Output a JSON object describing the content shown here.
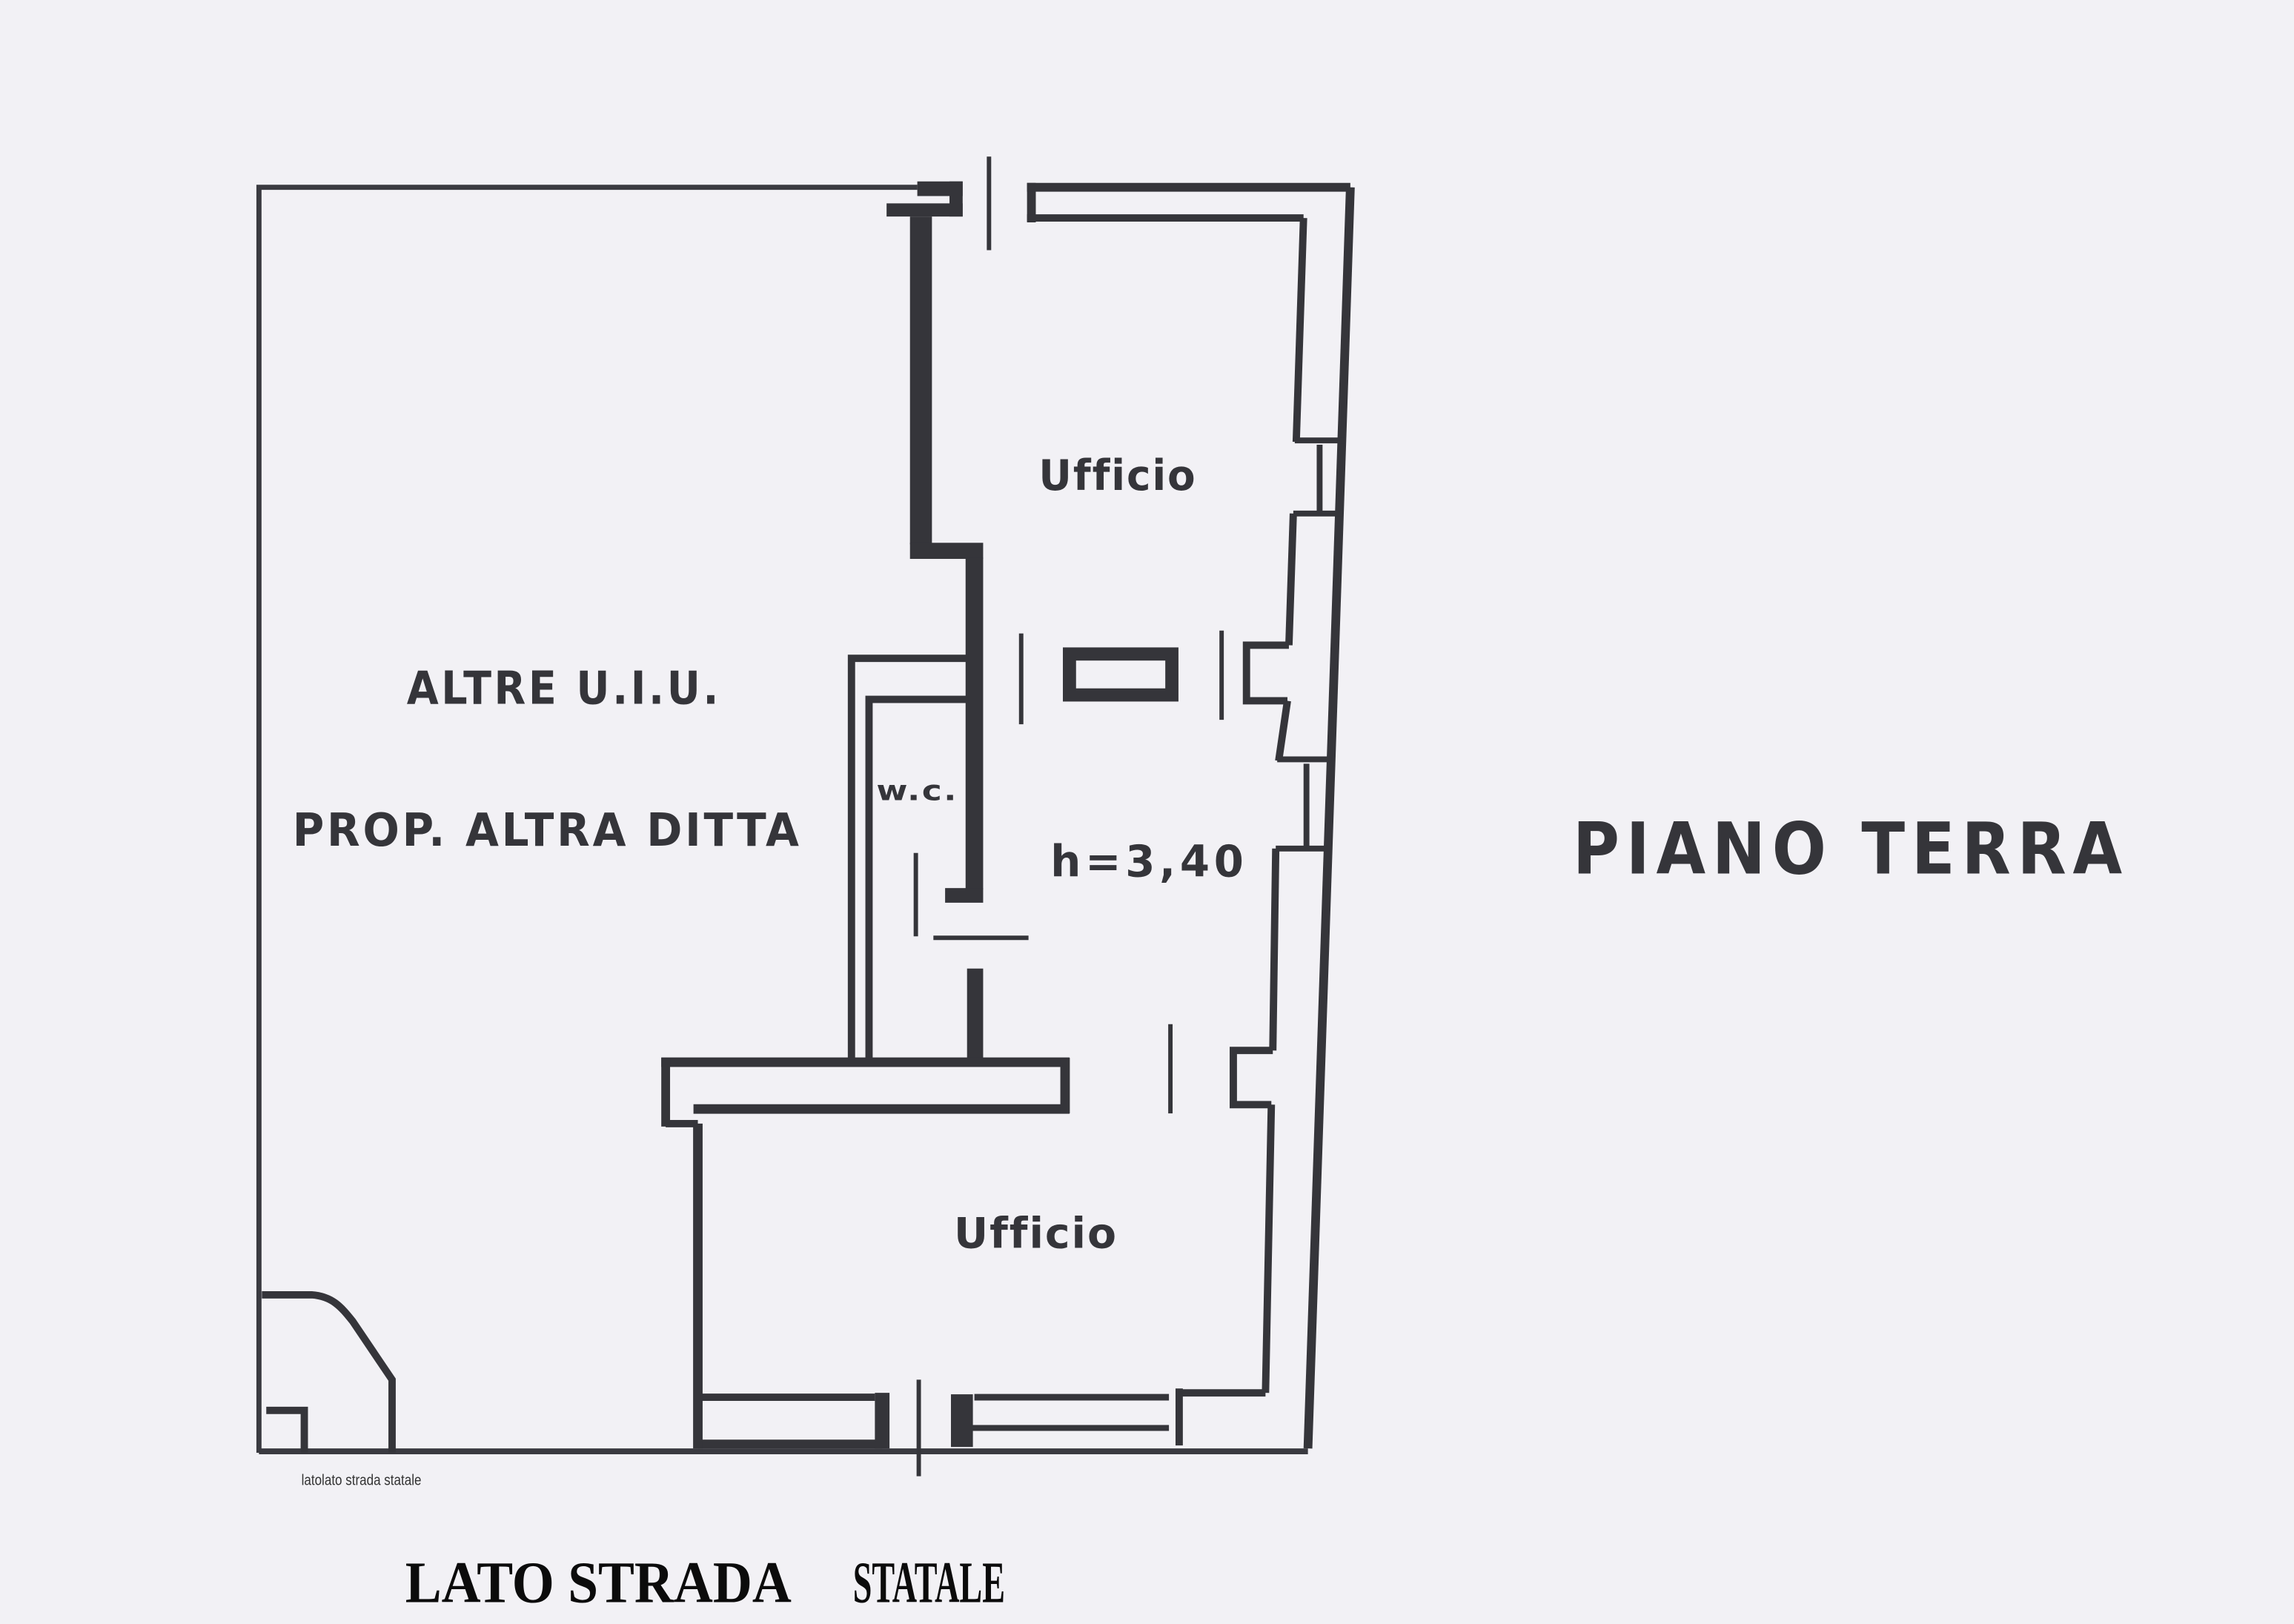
{
  "colors": {
    "paper": "#f2f1f5",
    "ink": "#35353a",
    "caption": "#0b0b0b",
    "annotation": "#333333"
  },
  "floor_plan": {
    "room_labels": [
      {
        "id": "office-top",
        "text": "Ufficio"
      },
      {
        "id": "wc",
        "text": "w.c."
      },
      {
        "id": "office-bottom",
        "text": "Ufficio"
      }
    ],
    "area_note_line1": "ALTRE U.I.U.",
    "area_note_line2": "PROP. ALTRA DITTA",
    "height_note": "h=3,40"
  },
  "titles": {
    "floor": "PIANO TERRA",
    "street_caption_part1": "LATO STRADA",
    "street_caption_part2": "STATALE",
    "street_caption_small": "latolato strada statale"
  }
}
